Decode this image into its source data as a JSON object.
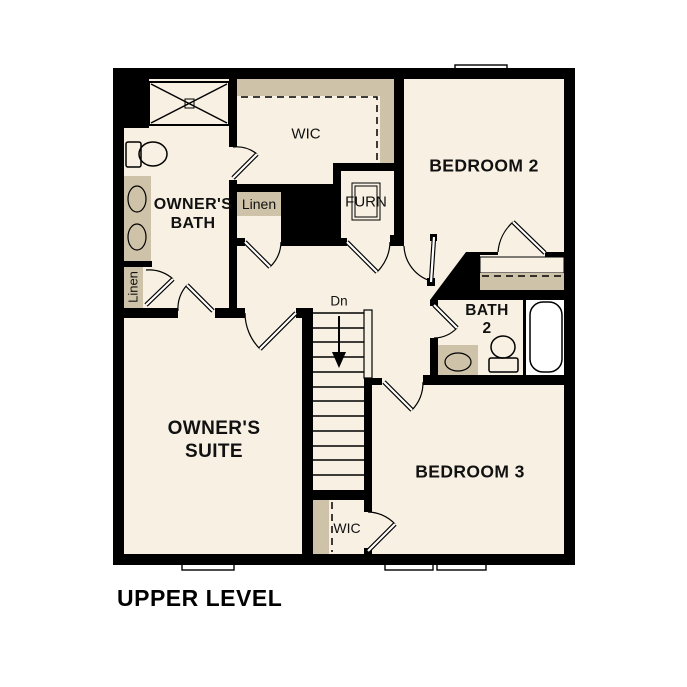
{
  "title": "UPPER LEVEL",
  "labels": {
    "upper_level": "UPPER LEVEL",
    "wic_top": "WIC",
    "wic_bottom": "WIC",
    "owners_bath_1": "OWNER'S",
    "owners_bath_2": "BATH",
    "owners_suite_1": "OWNER'S",
    "owners_suite_2": "SUITE",
    "bedroom2": "BEDROOM 2",
    "bedroom3": "BEDROOM 3",
    "bath2_1": "BATH",
    "bath2_2": "2",
    "linen_left": "Linen",
    "linen_mid": "Linen",
    "furn": "FURN",
    "stairs_dn": "Dn"
  },
  "colors": {
    "floor": "#F7F0E3",
    "shelf": "#CEC2A8",
    "fixture": "#A9C7E7",
    "unit": "#DBDBDB",
    "wall": "#000000",
    "ink": "#111111"
  },
  "icons": [
    "shower-icon",
    "toilet-icon",
    "double-vanity-sinks-icon",
    "bathtub-icon",
    "sink-icon",
    "furnace-icon",
    "stairs-icon",
    "down-arrow-icon",
    "window-icon",
    "door-swing-icon",
    "closet-rod-dashed-icon"
  ]
}
